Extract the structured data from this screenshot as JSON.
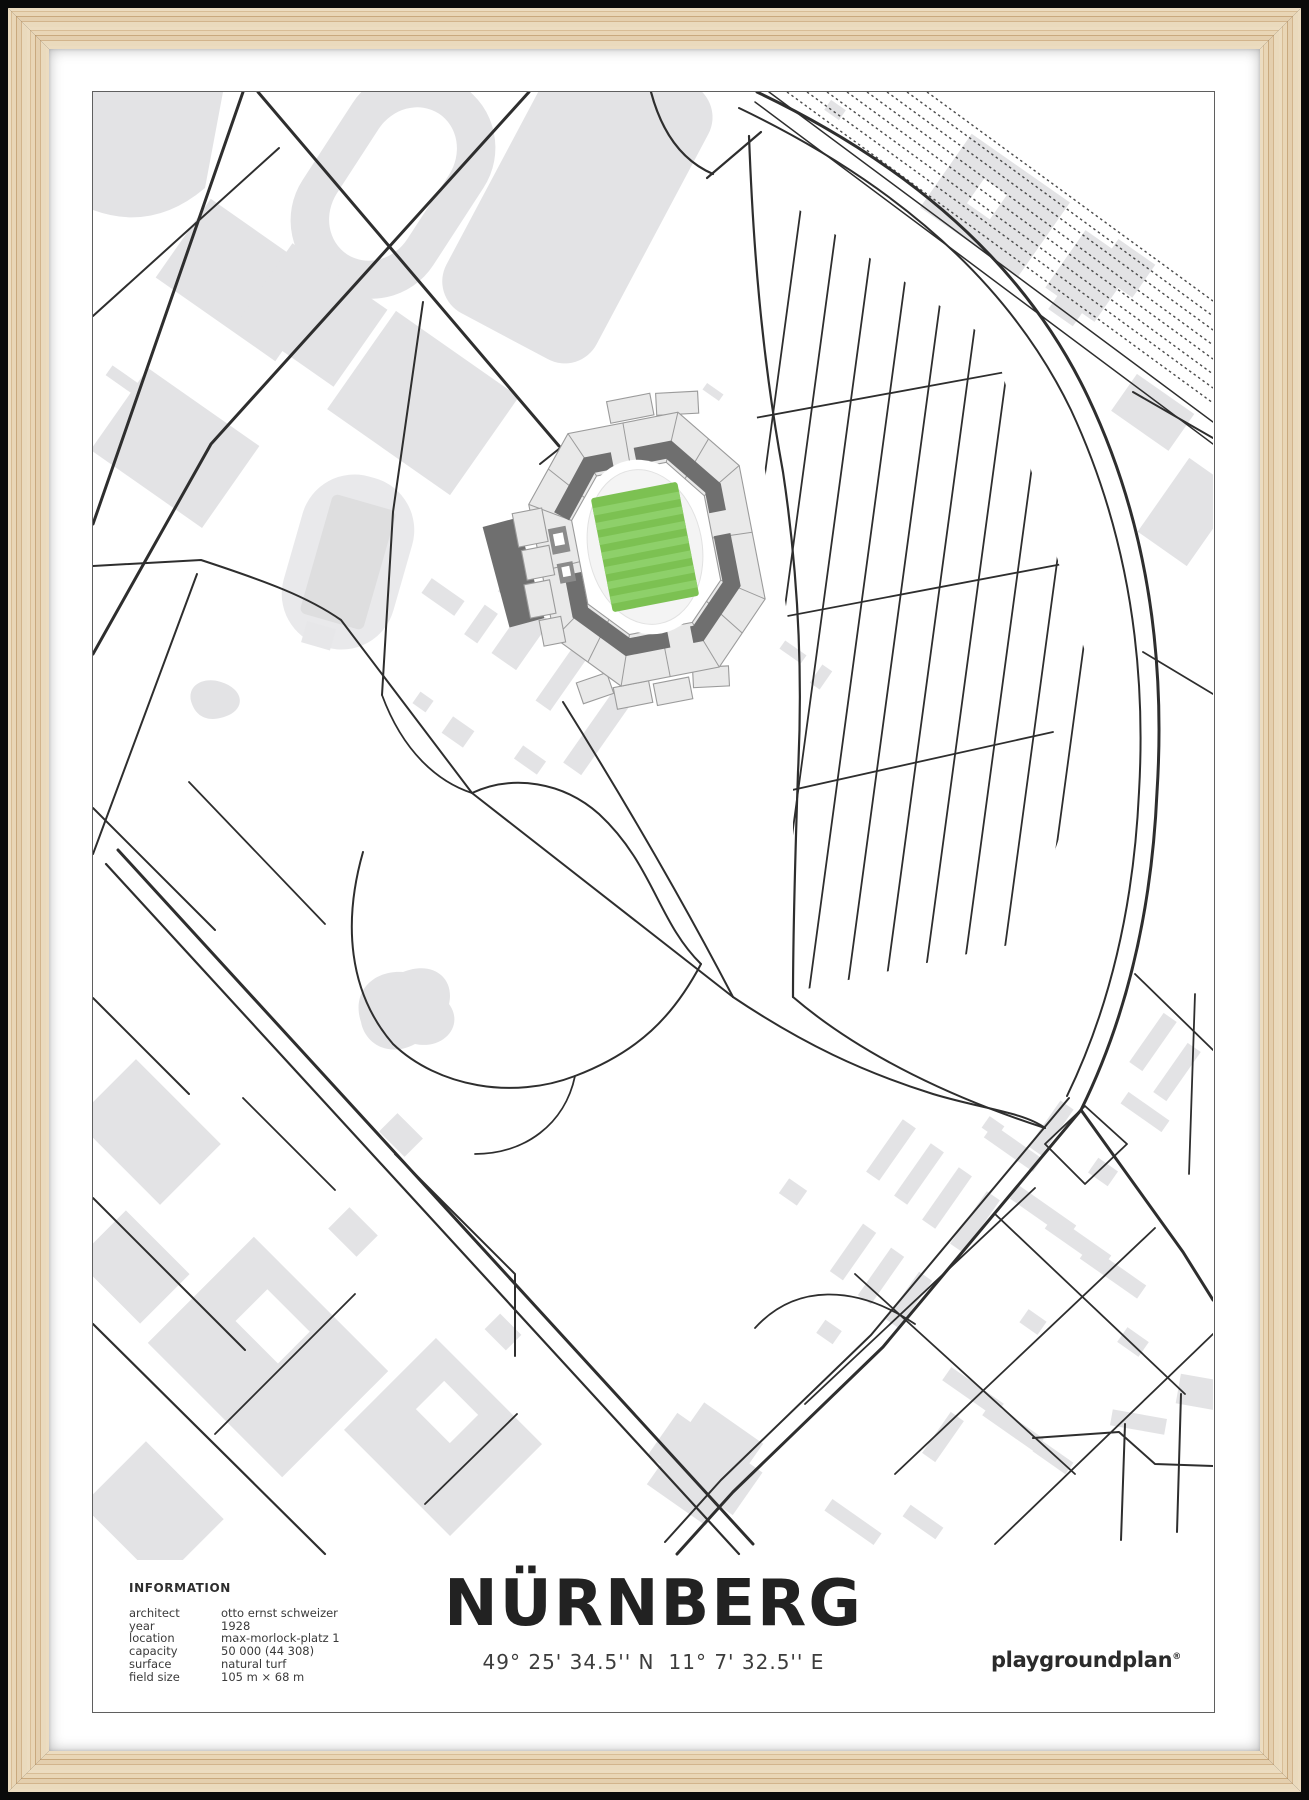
{
  "poster": {
    "title": "NÜRNBERG",
    "coordinates": {
      "lat": "49° 25' 34.5'' N",
      "lon": "11° 7' 32.5'' E"
    },
    "brand": {
      "name": "playgroundplan",
      "mark": "®"
    },
    "info": {
      "heading": "INFORMATION",
      "rows": [
        {
          "label": "architect",
          "value": "otto ernst schweizer"
        },
        {
          "label": "year",
          "value": "1928"
        },
        {
          "label": "location",
          "value": "max-morlock-platz 1"
        },
        {
          "label": "capacity",
          "value": "50 000 (44 308)"
        },
        {
          "label": "surface",
          "value": "natural turf"
        },
        {
          "label": "field size",
          "value": "105 m × 68 m"
        }
      ]
    }
  },
  "colors": {
    "pitch_green": "#7cc152",
    "pitch_stripe": "#8ed06a",
    "building_gray": "#e3e3e5",
    "stand_dark": "#6f6f6f",
    "stand_light": "#e9e9e9",
    "road": "#2e2e2e",
    "wood_frame": "#e7d5b5",
    "poster_border": "#5f5f5f",
    "mat_white": "#ffffff"
  }
}
